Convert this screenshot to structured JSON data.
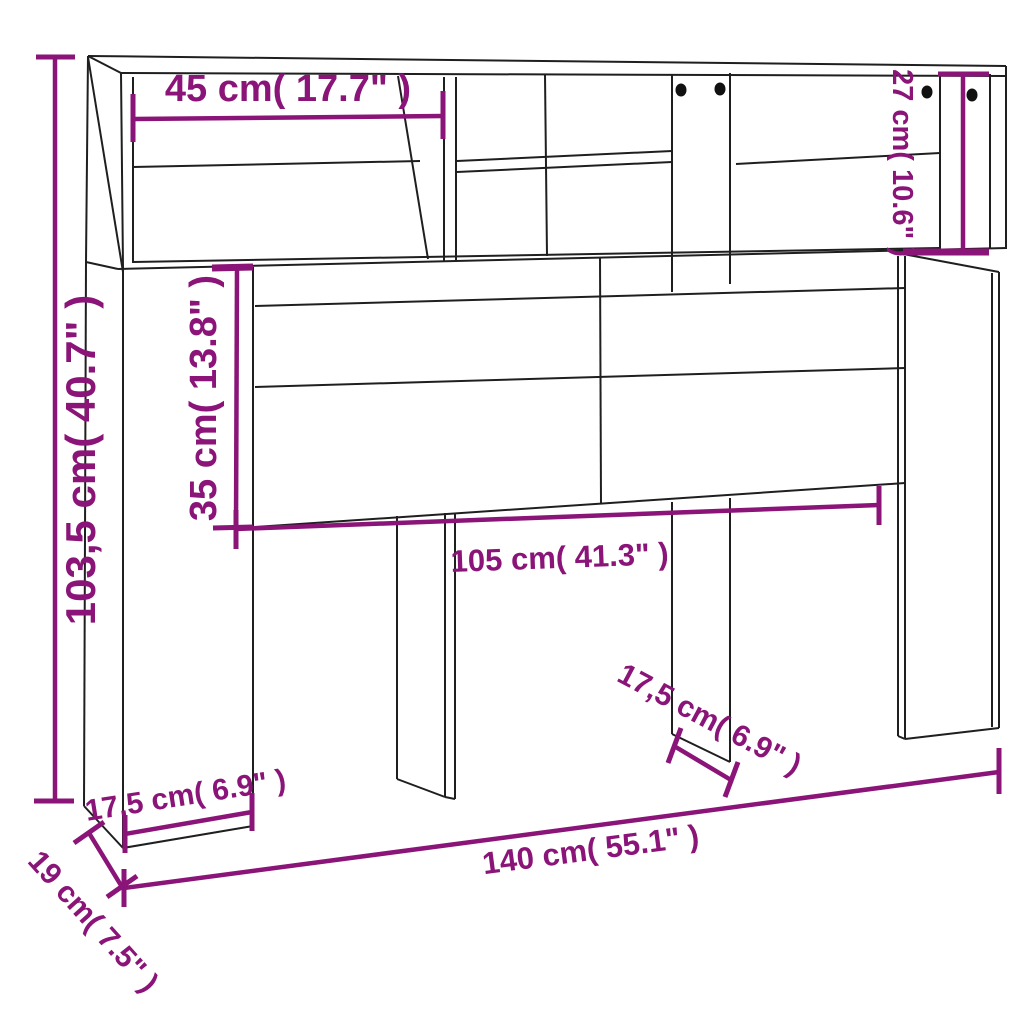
{
  "title": "Headboard cabinet dimension diagram",
  "diagram": {
    "labels": {
      "overall_height": "103,5 cm( 40.7\" )",
      "shelf_width": "45 cm( 17.7\" )",
      "top_depth": "27 cm( 10.6\" )",
      "panel_height": "35 cm( 13.8\" )",
      "inner_width": "105 cm( 41.3\" )",
      "left_column_width": "17,5 cm( 6.9\" )",
      "leg_width": "17,5 cm( 6.9\" )",
      "overall_width": "140 cm( 55.1\" )",
      "overall_depth": "19 cm( 7.5\" )"
    },
    "colors": {
      "dimension": "#8a1478",
      "outline": "#1f1f1f",
      "background": "#ffffff"
    }
  }
}
